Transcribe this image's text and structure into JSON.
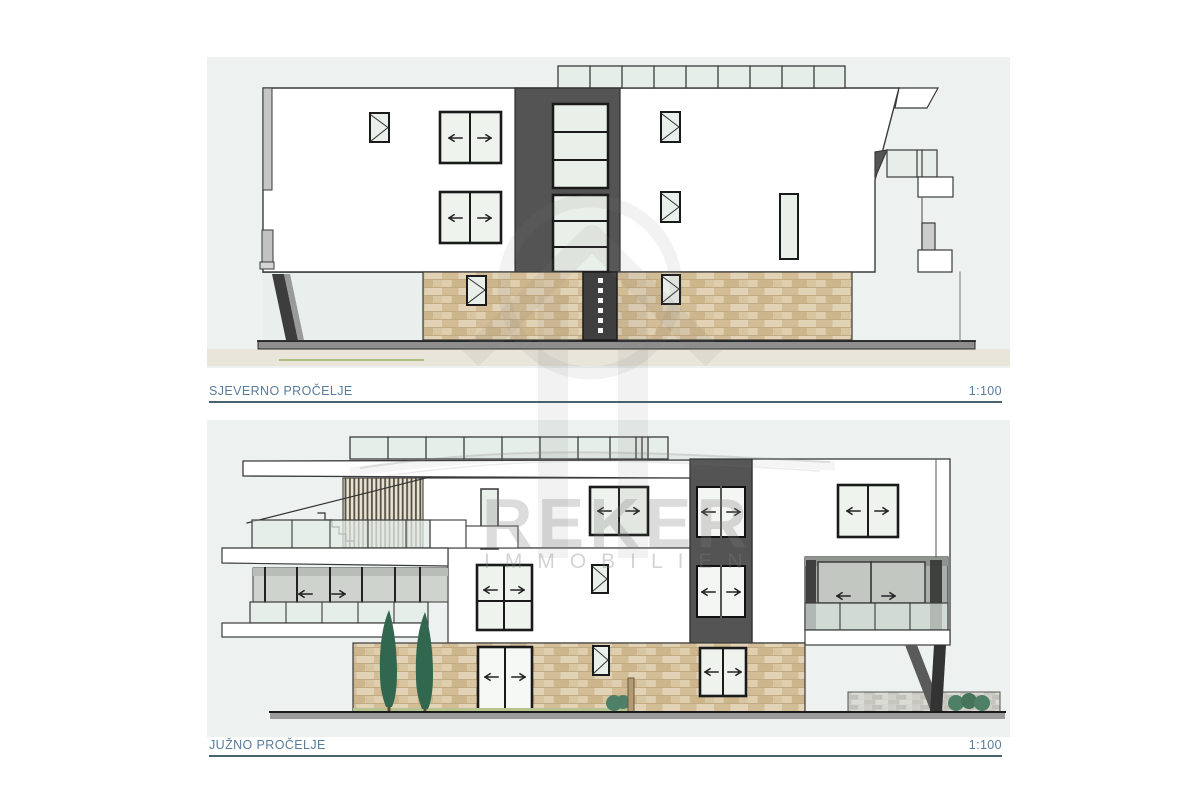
{
  "title_block": {
    "north": {
      "label": "SJEVERNO PROČELJE",
      "scale": "1:100"
    },
    "south": {
      "label": "JUŽNO PROČELJE",
      "scale": "1:100"
    }
  },
  "watermark": {
    "brand": "REKER",
    "subtitle": "IMMOBILIEN"
  },
  "colors": {
    "panel_background": "#edf2f1",
    "label_text": "#587c9b",
    "label_underline": "#4a646f",
    "dark_wall": "#545454",
    "stone_wall": "#dac7a4",
    "window_glass": "#e9efe9",
    "ground_strip": "#9b9b9b",
    "ground_beige": "#eae5da",
    "grass_line": "#a9bf7d",
    "tree_green": "#32674f"
  }
}
